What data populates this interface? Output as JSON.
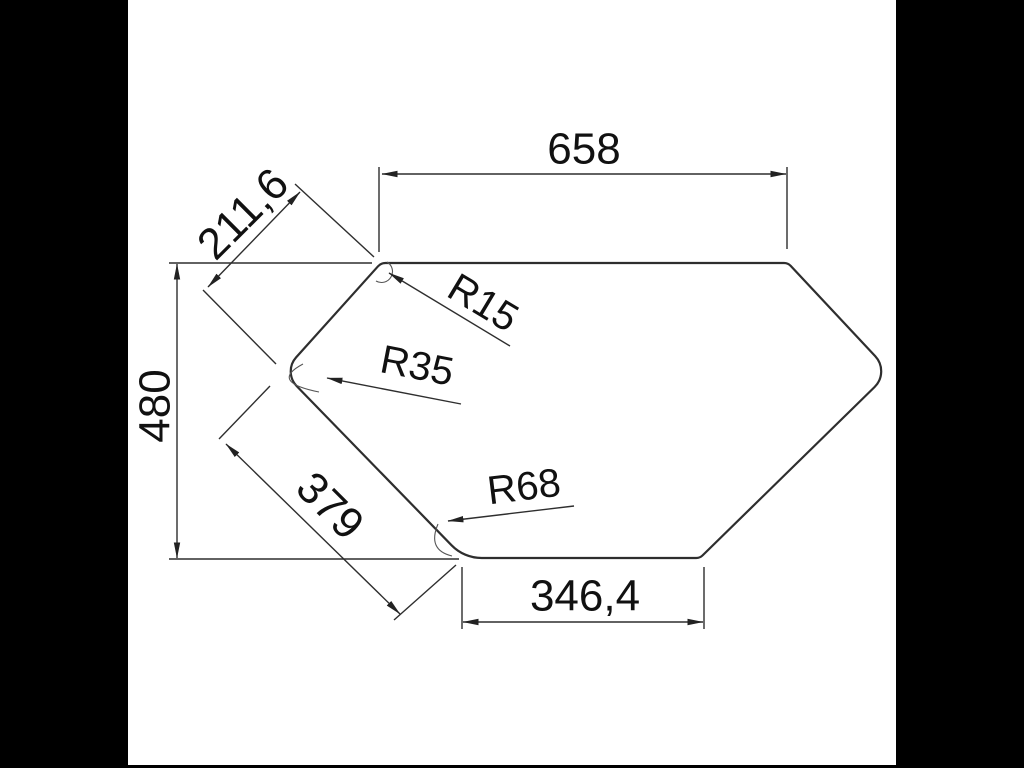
{
  "drawing": {
    "dimension_labels": {
      "top_width": "658",
      "upper_left_edge": "211,6",
      "height": "480",
      "lower_left_edge": "379",
      "bottom_width": "346,4"
    },
    "radius_labels": {
      "top_left_corner": "R15",
      "left_corner": "R35",
      "bottom_left_corner": "R68"
    },
    "colors": {
      "background": "#000000",
      "paper": "#ffffff",
      "line": "#2e2e2e",
      "text": "#111111"
    }
  }
}
